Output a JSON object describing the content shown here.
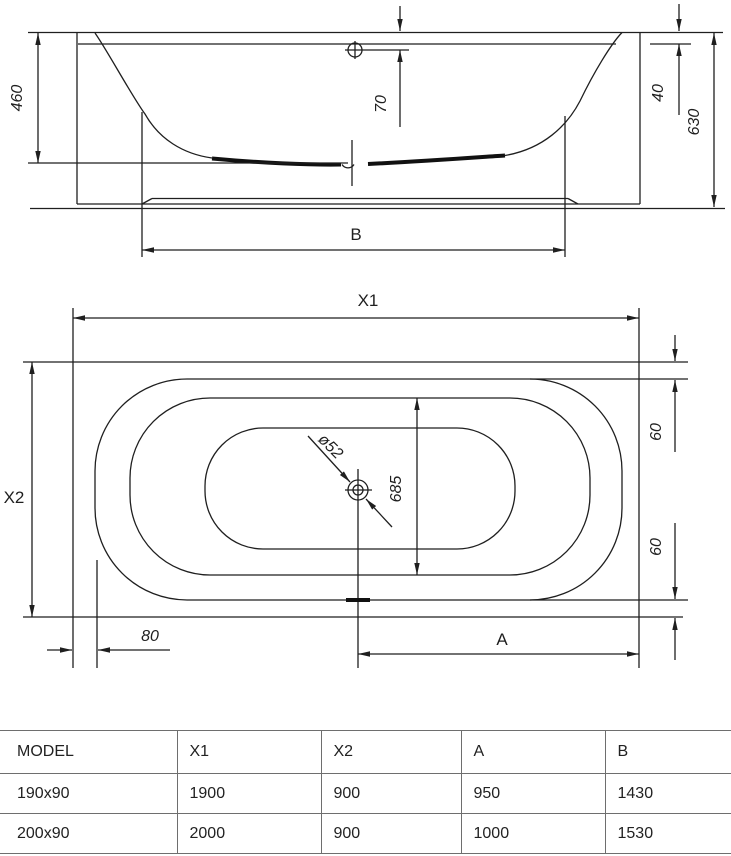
{
  "drawing": {
    "side_view": {
      "depth": "460",
      "overflow_offset": "70",
      "rim_height": "40",
      "total_height": "630",
      "bottom_length_label": "B"
    },
    "plan_view": {
      "length_label": "X1",
      "width_label": "X2",
      "rim_width_top": "60",
      "rim_width_bottom": "60",
      "inner_width": "685",
      "drain_diameter": "ø52",
      "left_offset": "80",
      "drain_distance_label": "A"
    }
  },
  "table": {
    "headers": [
      "MODEL",
      "X1",
      "X2",
      "A",
      "B"
    ],
    "rows": [
      {
        "model": "190x90",
        "x1": "1900",
        "x2": "900",
        "a": "950",
        "b": "1430"
      },
      {
        "model": "200x90",
        "x1": "2000",
        "x2": "900",
        "a": "1000",
        "b": "1530"
      }
    ]
  },
  "colors": {
    "line": "#1f1f1f",
    "table_border": "#6e6e6e",
    "text": "#222222",
    "background": "#ffffff"
  }
}
